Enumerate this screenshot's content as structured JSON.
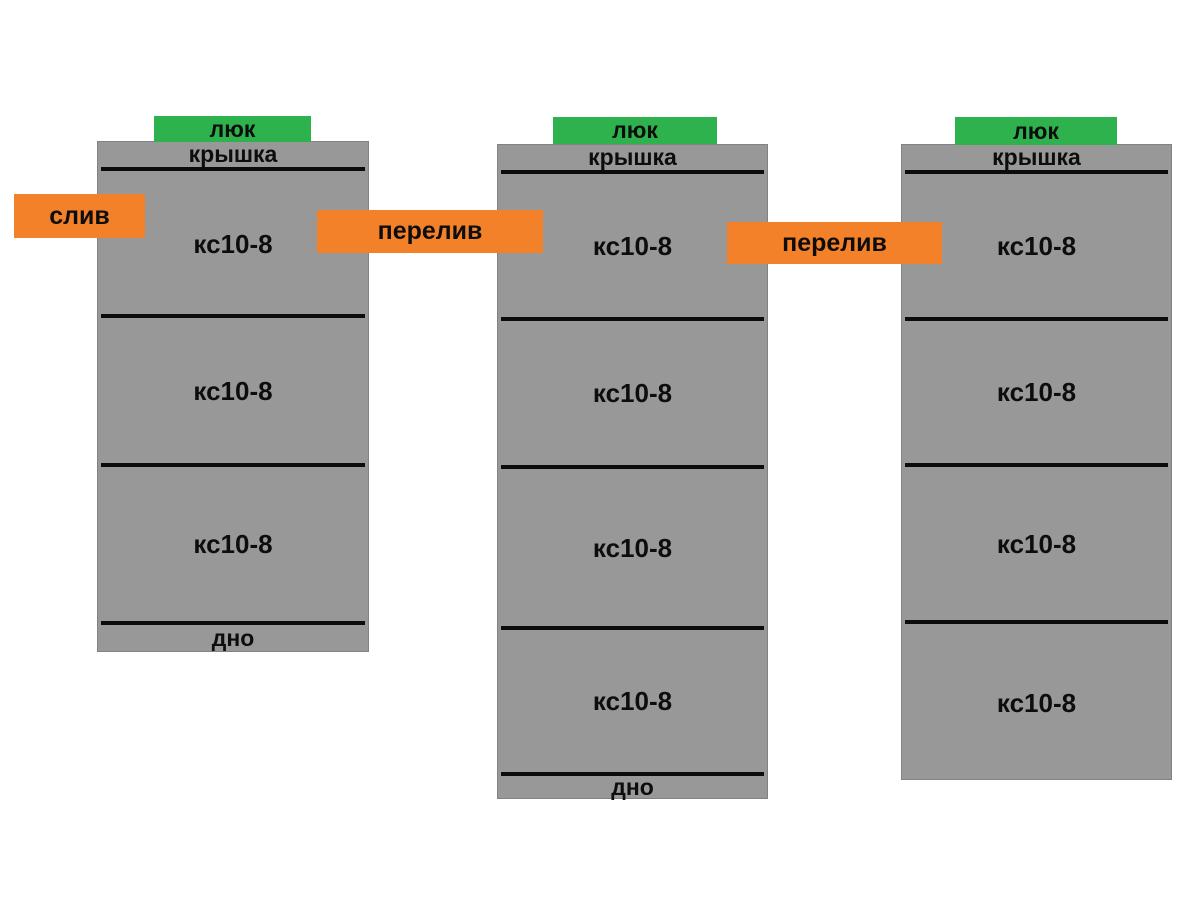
{
  "diagram": {
    "colors": {
      "well_gray": "#989898",
      "well_border": "#828282",
      "hatch_green": "#2db24d",
      "connector_orange": "#f3812a",
      "divider_black": "#0c0c0c",
      "background": "#ffffff"
    },
    "wells": [
      {
        "hatch_label": "люк",
        "cover_label": "крышка",
        "rings": [
          "кс10-8",
          "кс10-8",
          "кс10-8"
        ],
        "bottom_label": "дно"
      },
      {
        "hatch_label": "люк",
        "cover_label": "крышка",
        "rings": [
          "кс10-8",
          "кс10-8",
          "кс10-8",
          "кс10-8"
        ],
        "bottom_label": "дно"
      },
      {
        "hatch_label": "люк",
        "cover_label": "крышка",
        "rings": [
          "кс10-8",
          "кс10-8",
          "кс10-8",
          "кс10-8"
        ]
      }
    ],
    "connectors": {
      "drain_label": "слив",
      "overflow1_label": "перелив",
      "overflow2_label": "перелив"
    }
  }
}
